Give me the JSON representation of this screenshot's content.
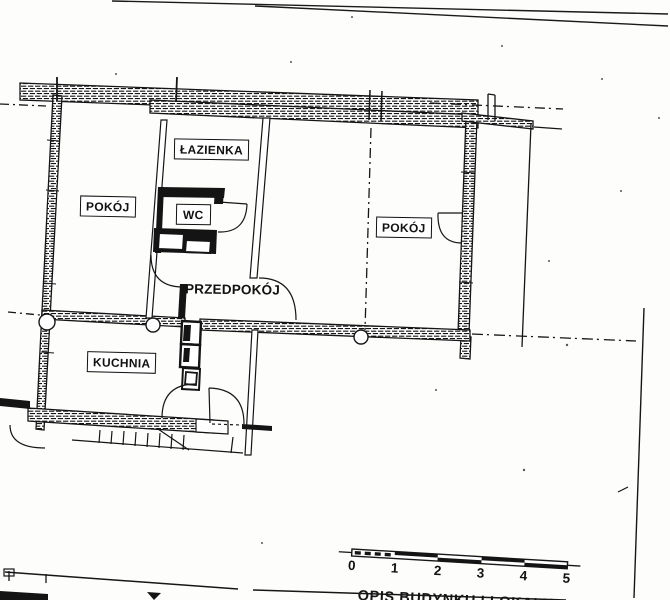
{
  "document": {
    "type": "scanned floor plan",
    "ink_color": "#151515",
    "paper_color": "#fdfdfc"
  },
  "rooms": [
    {
      "id": "room-left",
      "label": "POKÓJ"
    },
    {
      "id": "bathroom",
      "label": "ŁAZIENKA"
    },
    {
      "id": "wc",
      "label": "WC"
    },
    {
      "id": "hallway",
      "label": "PRZEDPOKÓJ"
    },
    {
      "id": "kitchen",
      "label": "KUCHNIA"
    },
    {
      "id": "room-right",
      "label": "POKÓJ"
    }
  ],
  "scale_bar": {
    "labels": [
      "0",
      "1",
      "2",
      "3",
      "4",
      "5"
    ]
  },
  "footer": {
    "caption": "OPIS BUDYNKU I LOKALU"
  }
}
